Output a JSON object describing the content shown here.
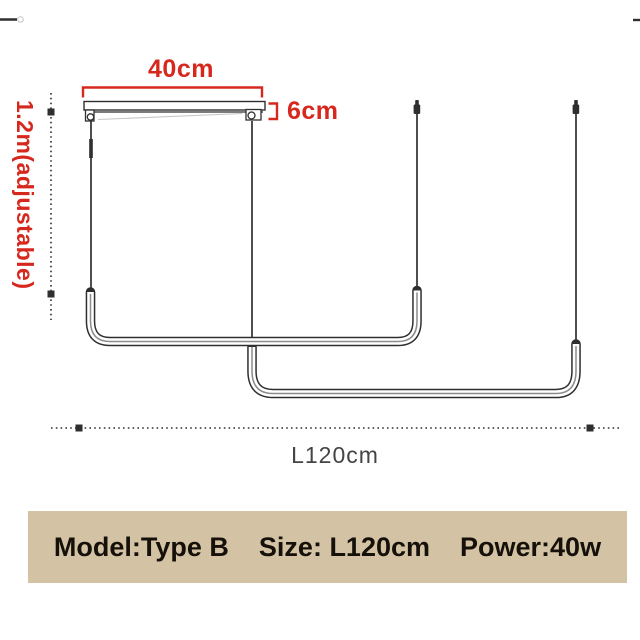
{
  "diagram": {
    "labels": {
      "width": "40cm",
      "canopy_height": "6cm",
      "drop_height": "1.2m(adjustable)",
      "length": "L120cm"
    },
    "parts": {
      "canopy": "ceiling-mount-bar",
      "suspension_wires": 4,
      "light_bars": 2
    }
  },
  "banner": {
    "model": "Model:Type B",
    "size": "Size: L120cm",
    "power": "Power:40w"
  },
  "colors": {
    "accent_red": "#d7281e",
    "line": "#2f2f2f",
    "banner_bg": "#d3c3a4",
    "banner_text": "#15100a",
    "muted_text": "#444444"
  }
}
